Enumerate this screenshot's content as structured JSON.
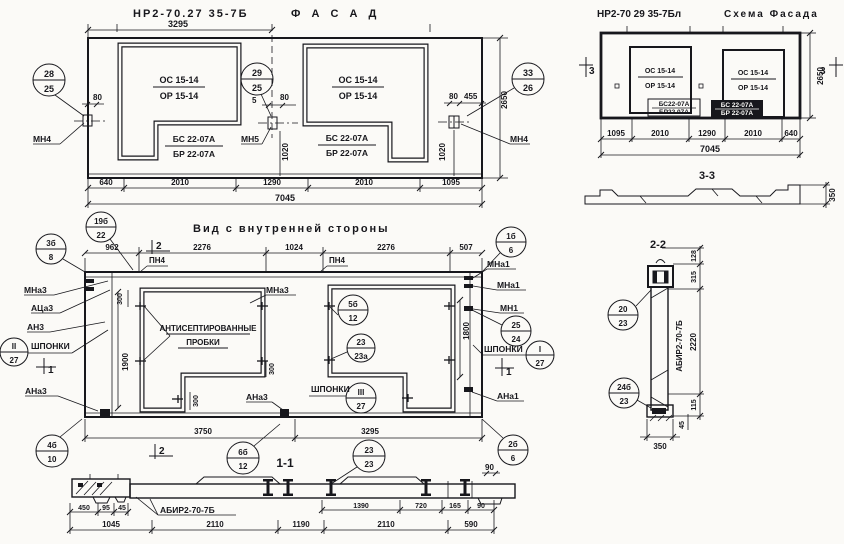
{
  "facade": {
    "title_code": "НР2-70.27 35-7Б",
    "title_word": "Ф А С А Д",
    "dim_half_width": "3295",
    "window1": {
      "line1": "ОС 15-14",
      "line2": "ОР 15-14"
    },
    "window2": {
      "line1": "ОС 15-14",
      "line2": "ОР 15-14"
    },
    "sill1": {
      "line1": "БС 22-07А",
      "line2": "БР 22-07А"
    },
    "sill2": {
      "line1": "БС 22-07А",
      "line2": "БР 22-07А"
    },
    "callout_left": {
      "num": "28",
      "den": "25"
    },
    "callout_mid": {
      "num": "29",
      "den": "25"
    },
    "callout_right": {
      "num": "33",
      "den": "26"
    },
    "anchor_left": "МН4",
    "anchor_mid": "МН5",
    "anchor_right": "МН4",
    "dim_80_left": "80",
    "dim_5_mid": "5",
    "dim_80_mid": "80",
    "dim_80_right": "80",
    "dim_455_right": "455",
    "dim_1020_mid": "1020",
    "dim_1020_right": "1020",
    "dim_height": "2650",
    "dims_bottom": [
      "640",
      "2010",
      "1290",
      "2010",
      "1095"
    ],
    "dim_total": "7045"
  },
  "schema": {
    "title_code": "НР2-70 29 35-7Бл",
    "title_word": "Схема Фасада",
    "window1": {
      "line1": "ОС 15-14",
      "line2": "ОР 15-14"
    },
    "window2": {
      "line1": "ОС 15-14",
      "line2": "ОР 15-14"
    },
    "sill1": {
      "line1": "БС22-07А",
      "line2": "БР22 07А"
    },
    "sill2": {
      "line1": "БС 22-07А",
      "line2": "БР 22-07А"
    },
    "marker_left": "3",
    "marker_right": "3",
    "dim_height": "2650",
    "dims_bottom": [
      "1095",
      "2010",
      "1290",
      "2010",
      "640"
    ],
    "dim_total": "7045",
    "section_label": "3-3",
    "dim_350": "350"
  },
  "view": {
    "title": "Вид с внутренней стороны",
    "dims_top": [
      "962",
      "2276",
      "1024",
      "2276",
      "507"
    ],
    "pn4_left": "ПН4",
    "pn4_mid": "ПН4",
    "marker2_top": "2",
    "marker2_bottom": "2",
    "marker1_left": "1",
    "marker1_right": "1",
    "callout_19b22": {
      "num": "19б",
      "den": "22"
    },
    "callout_3b8": {
      "num": "3б",
      "den": "8"
    },
    "callout_1b6": {
      "num": "1б",
      "den": "6"
    },
    "callout_5b12": {
      "num": "5б",
      "den": "12"
    },
    "callout_2323a": {
      "num": "23",
      "den": "23а"
    },
    "callout_2524": {
      "num": "25",
      "den": "24"
    },
    "callout_III27": {
      "num": "III",
      "den": "27"
    },
    "callout_II27": {
      "num": "II",
      "den": "27"
    },
    "callout_I27": {
      "num": "I",
      "den": "27"
    },
    "callout_4b10": {
      "num": "4б",
      "den": "10"
    },
    "callout_6b12": {
      "num": "6б",
      "den": "12"
    },
    "callout_2323": {
      "num": "23",
      "den": "23"
    },
    "callout_2b6": {
      "num": "2б",
      "den": "6"
    },
    "label_mna3_left": "МНа3",
    "label_aca3_left": "АЦа3",
    "label_an3_left": "АН3",
    "label_shponki_left": "ШПОНКИ",
    "label_ana3_left": "АНа3",
    "label_mna3_mid": "МНа3",
    "label_ana3_mid": "АНа3",
    "label_shponki_mid": "ШПОНКИ",
    "label_mna1_right1": "МНа1",
    "label_mna1_right2": "МНа1",
    "label_mn1_right": "МН1",
    "label_shponki_right": "ШПОНКИ",
    "label_ana1_right": "АНа1",
    "plugs_line1": "АНТИСЕПТИРОВАННЫЕ",
    "plugs_line2": "ПРОБКИ",
    "dim_300_tl": "300",
    "dim_300_bl": "300",
    "dim_300_mid": "300",
    "dim_1900": "1900",
    "dim_1800": "1800",
    "dims_bottom": [
      "3750",
      "3295"
    ]
  },
  "section11": {
    "title": "1-1",
    "beam_label": "АБИР2-70-7Б",
    "dims_row1_left": [
      "450",
      "95",
      "45"
    ],
    "dims_row1_right": [
      "1390",
      "720",
      "165",
      "90"
    ],
    "dims_row2": [
      "1045",
      "2110",
      "1190",
      "2110",
      "590"
    ],
    "dim_90_vert": "90"
  },
  "section22": {
    "title": "2-2",
    "beam_label": "АБИР2-70-7Б",
    "dim_128": "128",
    "dim_315": "315",
    "dim_2220": "2220",
    "dim_115": "115",
    "dim_45": "45",
    "dim_350": "350",
    "callout_2023": {
      "num": "20",
      "den": "23"
    },
    "callout_24b23": {
      "num": "24б",
      "den": "23"
    }
  }
}
